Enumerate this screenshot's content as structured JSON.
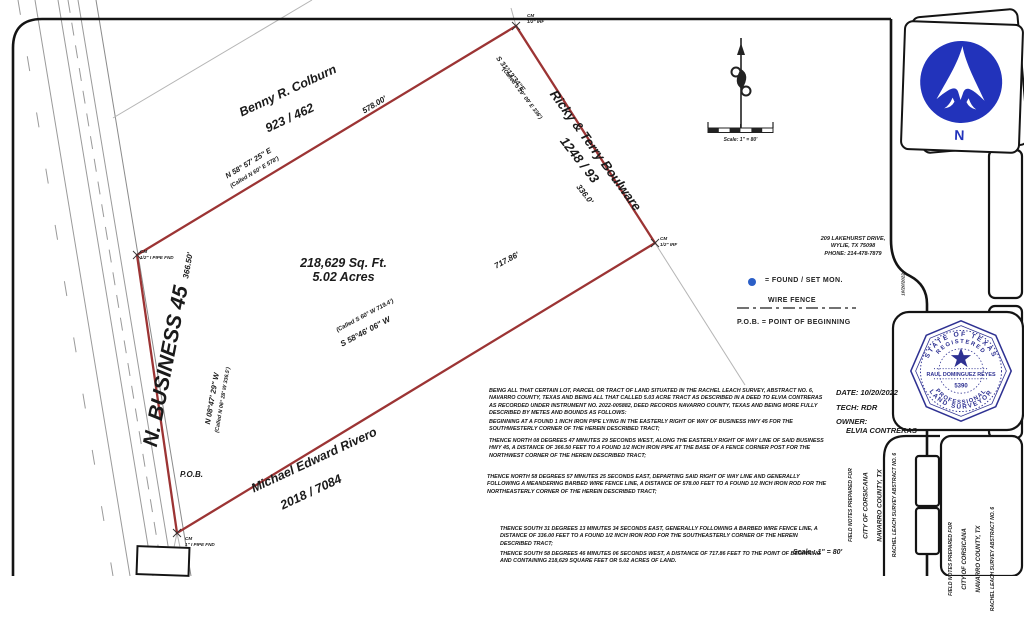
{
  "plat": {
    "area_sqft": "218,629 Sq. Ft.",
    "area_acres": "5.02 Acres",
    "pob": "P.O.B.",
    "road_name": "N. BUSINESS 45",
    "scale_text": "Scale : 1\" = 80'",
    "scale_bar_text": "Scale: 1\" = 80'"
  },
  "boundaries": {
    "north": {
      "distance": "578.00'",
      "bearing": "N 58° 57' 25\" E",
      "called": "(Called N 60° E 578')"
    },
    "east": {
      "distance": "336.0'",
      "bearing": "S 31°13'34\"E",
      "called": "(Called S 29° 09' E 336')"
    },
    "south": {
      "distance": "717.86'",
      "bearing": "S 58°46' 06\" W",
      "called": "(Called S 60° W 719.4')"
    },
    "west": {
      "distance": "366.50'",
      "bearing": "N 08°47' 29\" W",
      "called": "(Called N 06° 28' W 336.5')"
    }
  },
  "neighbors": {
    "north": {
      "name": "Benny R. Colburn",
      "ref": "923 / 462"
    },
    "east": {
      "name": "Ricky & Terry Boulware",
      "ref": "1248 / 93"
    },
    "south": {
      "name": "Michael Edward Rivero",
      "ref": "2018 / 7084"
    }
  },
  "monuments": {
    "cm": "CM",
    "north": "1/2\" IRF",
    "east": "1/2\" IRF",
    "northwest": "1/2\" I PIPE FND",
    "south": "1\" I PIPE FND"
  },
  "legend": {
    "found": "= FOUND / SET MON.",
    "wire_fence": "WIRE FENCE",
    "pob": "P.O.B. = POINT OF BEGINNING"
  },
  "firm": {
    "address1": "209 LAKEHURST DRIVE,",
    "address2": "WYLIE, TX 75098",
    "address3": "PHONE: 214-478-7879"
  },
  "title_block": {
    "date": "DATE: 10/20/2022",
    "tech": "TECH: RDR",
    "owner_label": "OWNER:",
    "owner": "ELVIA CONTRERAS"
  },
  "seal": {
    "arc_top": "STATE OF TEXAS",
    "arc_top2": "REGISTERED",
    "name": "RAUL DOMINGUEZ REYES",
    "number": "5390",
    "arc_bottom2": "PROFESSIONAL",
    "arc_bottom": "LAND SURVEYOR",
    "side_date": "10/20/2022"
  },
  "sidebar": {
    "line1": "FIELD NOTES PREPARED FOR",
    "line2": "CITY OF CORSICANA",
    "line3": "NAVARRO COUNTY, TX",
    "line4": "RACHEL LEACH SURVEY ABSTRACT NO. 6"
  },
  "logo": {
    "n": "N"
  },
  "legal": {
    "p1": "BEING ALL THAT CERTAIN LOT, PARCEL OR TRACT OF LAND SITUATED IN THE RACHEL LEACH SURVEY, ABSTRACT NO. 6, NAVARRO COUNTY, TEXAS AND BEING ALL THAT CALLED 5.03 ACRE TRACT AS DESCRIBED IN A DEED TO ELVIA CONTRERAS AS RECORDED UNDER INSTRUMENT NO. 2022-005882, DEED RECORDS NAVARRO COUNTY, TEXAS AND BEING MORE FULLY DESCRIBED BY METES AND BOUNDS AS FOLLOWS:",
    "p2": "BEGINNING AT A FOUND 1 INCH IRON PIPE LYING IN THE EASTERLY RIGHT OF WAY OF BUSINESS HWY 45 FOR THE SOUTHWESTERLY CORNER OF THE HEREIN DESCRIBED TRACT;",
    "p3": "THENCE NORTH 08 DEGREES 47 MINUTES 29 SECONDS WEST, ALONG THE EASTERLY RIGHT OF WAY LINE OF SAID BUSINESS HWY 45, A DISTANCE OF 366.50 FEET TO A FOUND 1/2 INCH IRON PIPE AT THE BASE OF A FENCE CORNER POST FOR THE NORTHWEST CORNER OF THE HEREIN DESCRIBED TRACT;",
    "p4": "THENCE NORTH 58 DEGREES 57 MINUTES 25 SECONDS EAST, DEPARTING SAID RIGHT OF WAY LINE AND GENERALLY FOLLOWING A MEANDERING BARBED WIRE FENCE LINE, A DISTANCE OF 578.00 FEET TO A FOUND 1/2 INCH IRON ROD FOR THE NORTHEASTERLY CORNER OF THE HEREIN DESCRIBED TRACT;",
    "p5": "THENCE SOUTH 31 DEGREES 13 MINUTES 34 SECONDS EAST, GENERALLY FOLLOWING A BARBED WIRE FENCE LINE, A DISTANCE OF 336.00 FEET TO A FOUND 1/2 INCH IRON ROD FOR THE SOUTHEASTERLY CORNER OF THE HEREIN DESCRIBED TRACT;",
    "p6": "THENCE SOUTH 58 DEGREES 46 MINUTES 06 SECONDS WEST, A DISTANCE OF 717.86 FEET TO THE POINT OF BEGINNING AND CONTAINING 218,629 SQUARE FEET OR 5.02 ACRES OF LAND."
  }
}
